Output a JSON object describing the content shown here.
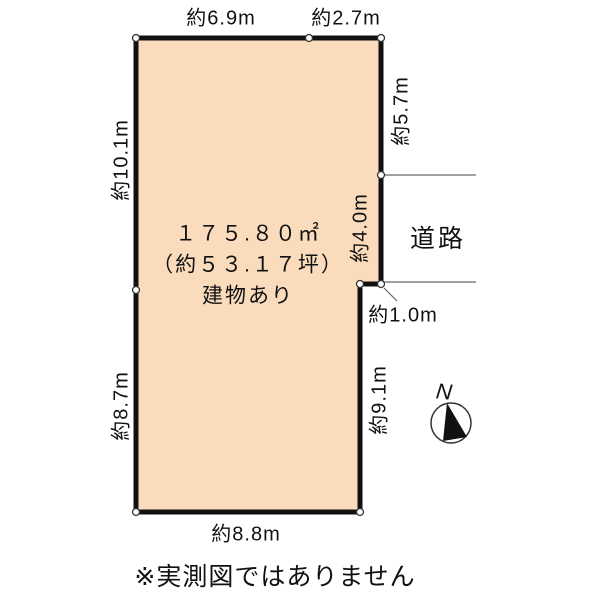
{
  "diagram": {
    "title_caption": "※実測図ではありません",
    "parcel": {
      "area_label": "１７５.８０㎡",
      "tsubo_label": "（約５３.１７坪）",
      "building_label": "建物あり"
    },
    "road_label": "道路",
    "compass": {
      "north_label": "N"
    },
    "dims": {
      "top_left": "約6.9m",
      "top_right": "約2.7m",
      "left_upper": "約10.1m",
      "left_lower": "約8.7m",
      "right_upper": "約5.7m",
      "right_middle": "約4.0m",
      "step": "約1.0m",
      "right_lower": "約9.1m",
      "bottom": "約8.8m"
    },
    "colors": {
      "parcel_fill": "#FADCBD",
      "outline": "#111111",
      "road_line": "#666666",
      "vertex_fill": "#FFFFFF"
    }
  }
}
